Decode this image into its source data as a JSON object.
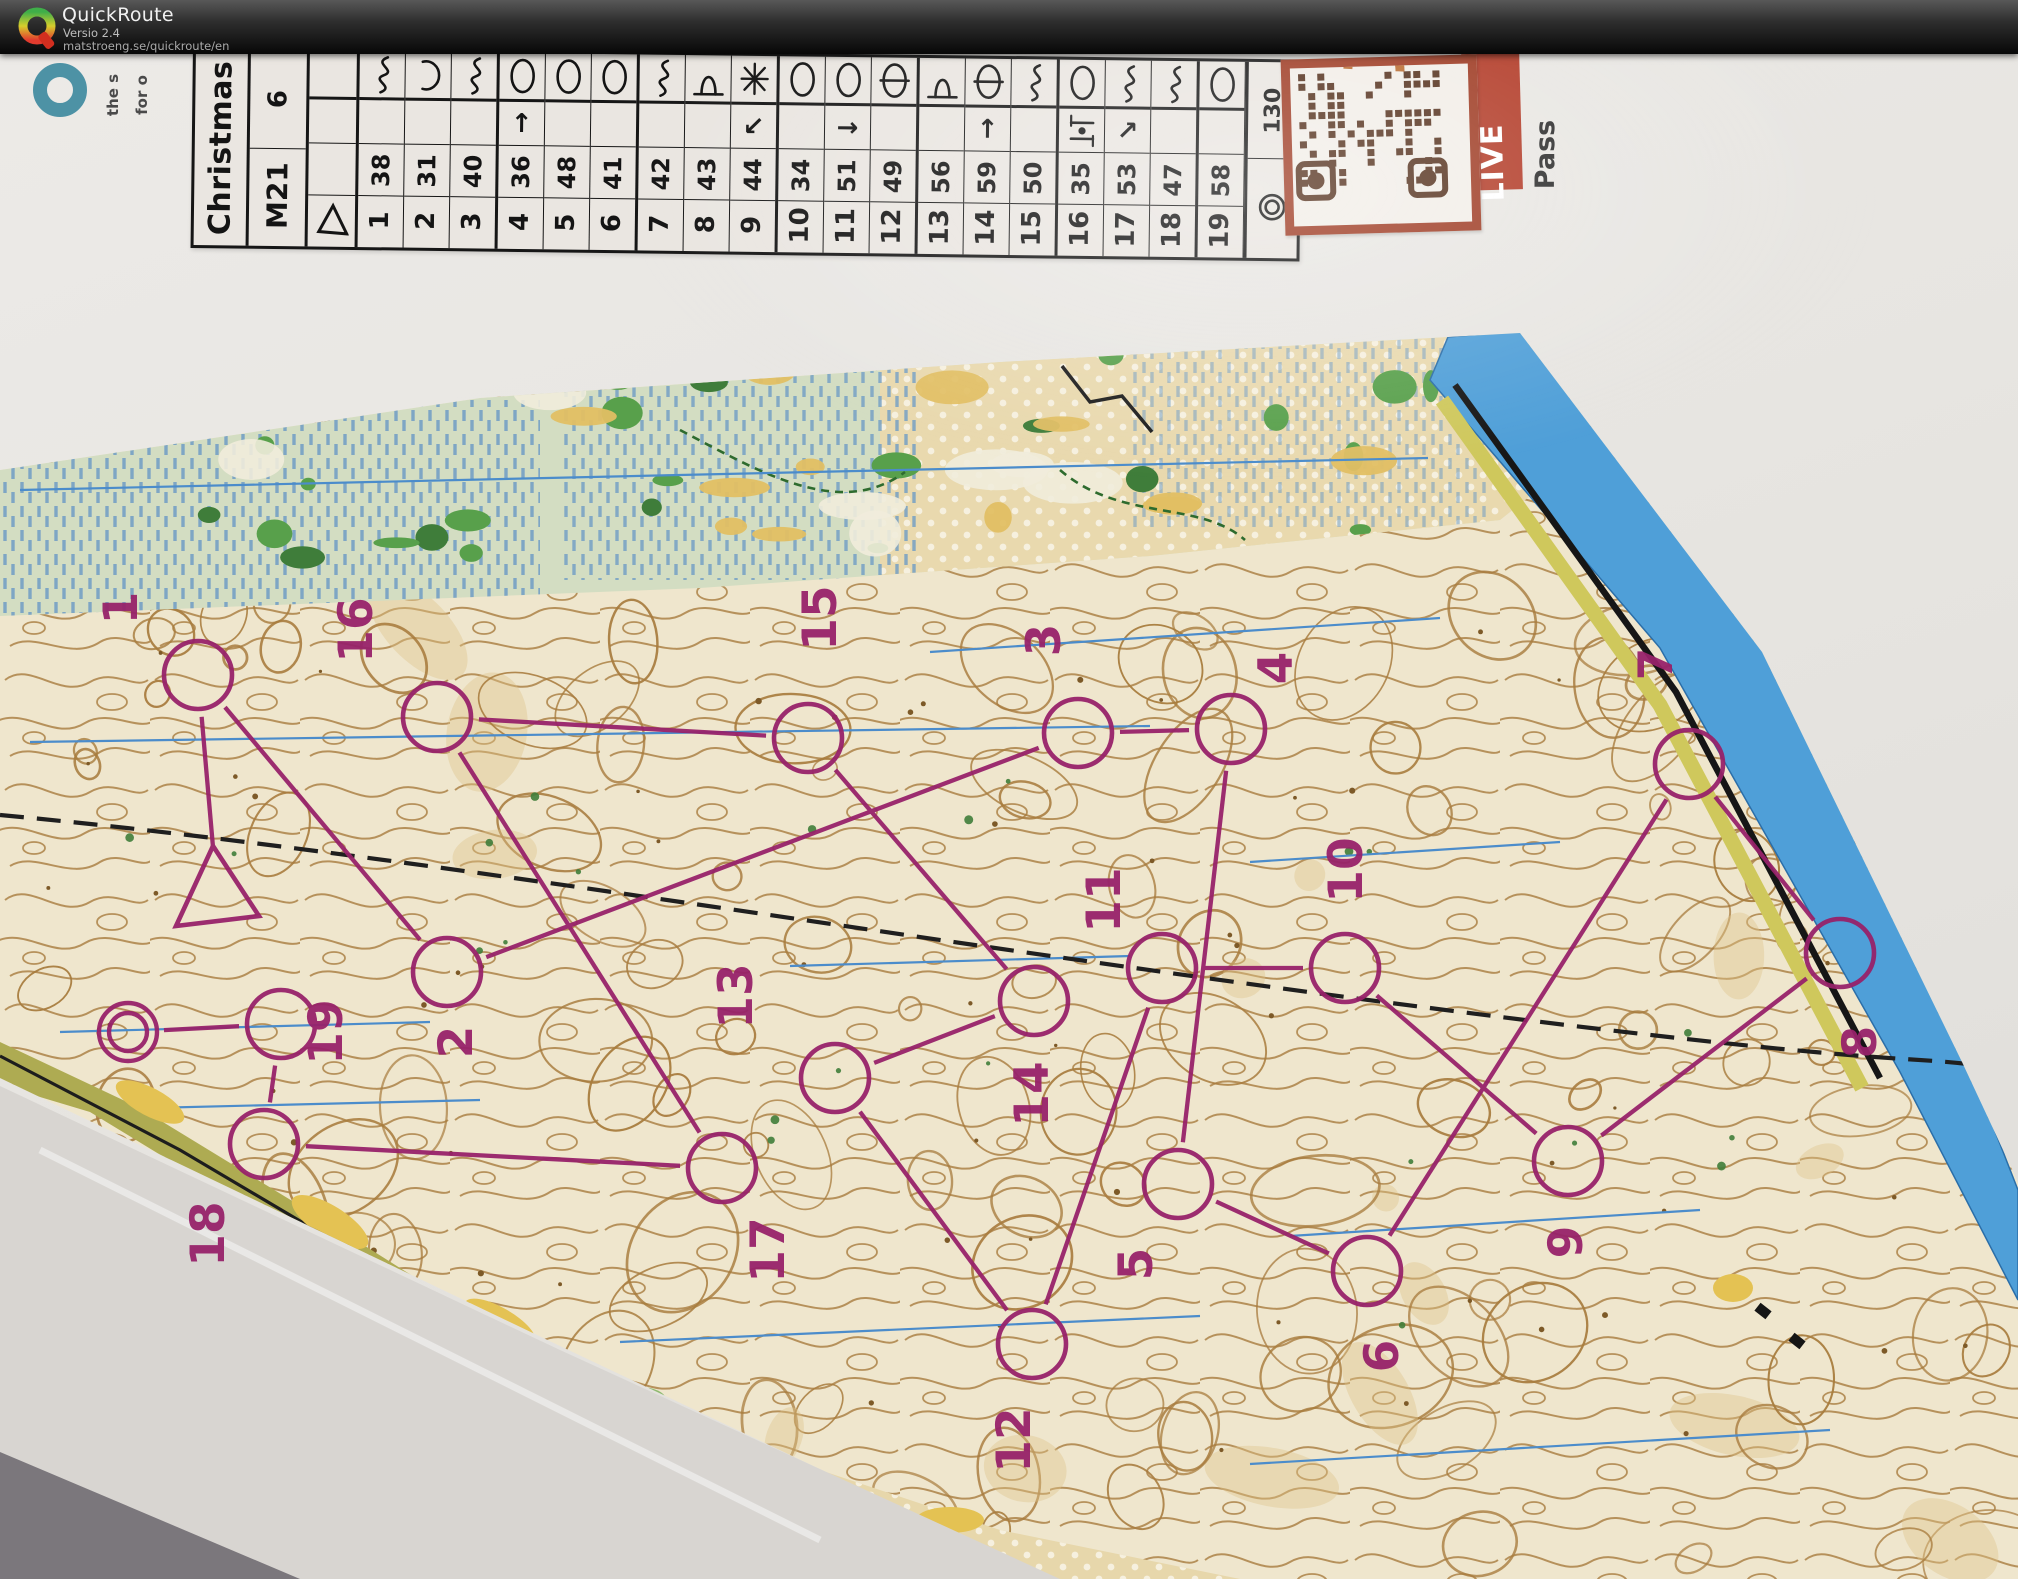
{
  "header": {
    "app_title": "QuickRoute",
    "version": "Versio 2.4",
    "website": "matstroeng.se/quickroute/en"
  },
  "photo": {
    "sponsor_logo": {
      "line1": "the s",
      "line2": "for o",
      "ring_color": "#4d92a5"
    },
    "sticker": {
      "live_label": "LIVE",
      "side_text": "Pass",
      "frame_color": "#9e3a22",
      "module_color": "#54301c"
    },
    "control_card": {
      "title": "Christmas",
      "course_class": "M21",
      "course_info": "6",
      "finish_distance": "130",
      "rows": [
        {
          "num": "1",
          "code": "38",
          "symbol": "curve",
          "arrow": ""
        },
        {
          "num": "2",
          "code": "31",
          "symbol": "c-open",
          "arrow": ""
        },
        {
          "num": "3",
          "code": "40",
          "symbol": "curve",
          "arrow": ""
        },
        {
          "num": "4",
          "code": "36",
          "symbol": "oval",
          "arrow": "↑"
        },
        {
          "num": "5",
          "code": "48",
          "symbol": "oval",
          "arrow": ""
        },
        {
          "num": "6",
          "code": "41",
          "symbol": "oval",
          "arrow": ""
        },
        {
          "num": "7",
          "code": "42",
          "symbol": "curve",
          "arrow": ""
        },
        {
          "num": "8",
          "code": "43",
          "symbol": "spur",
          "arrow": ""
        },
        {
          "num": "9",
          "code": "44",
          "symbol": "star",
          "arrow": "↙"
        },
        {
          "num": "10",
          "code": "34",
          "symbol": "oval",
          "arrow": ""
        },
        {
          "num": "11",
          "code": "51",
          "symbol": "oval",
          "arrow": "→"
        },
        {
          "num": "12",
          "code": "49",
          "symbol": "oval-bar",
          "arrow": ""
        },
        {
          "num": "13",
          "code": "56",
          "symbol": "spur",
          "arrow": ""
        },
        {
          "num": "14",
          "code": "59",
          "symbol": "oval-bar",
          "arrow": "↑"
        },
        {
          "num": "15",
          "code": "50",
          "symbol": "curve",
          "arrow": ""
        },
        {
          "num": "16",
          "code": "35",
          "symbol": "oval",
          "arrow": "between"
        },
        {
          "num": "17",
          "code": "53",
          "symbol": "curve",
          "arrow": "↗"
        },
        {
          "num": "18",
          "code": "47",
          "symbol": "curve",
          "arrow": ""
        },
        {
          "num": "19",
          "code": "58",
          "symbol": "oval",
          "arrow": ""
        }
      ]
    },
    "course": {
      "color": "#97226a",
      "start": {
        "x": 217,
        "y": 893
      },
      "finish": {
        "x": 128,
        "y": 1032
      },
      "controls": [
        {
          "num": "1",
          "cx": 198,
          "cy": 675,
          "lx": 137,
          "ly": 608
        },
        {
          "num": "2",
          "cx": 447,
          "cy": 972,
          "lx": 472,
          "ly": 1042
        },
        {
          "num": "3",
          "cx": 1078,
          "cy": 733,
          "lx": 1060,
          "ly": 640
        },
        {
          "num": "4",
          "cx": 1231,
          "cy": 729,
          "lx": 1292,
          "ly": 668
        },
        {
          "num": "5",
          "cx": 1178,
          "cy": 1184,
          "lx": 1152,
          "ly": 1264
        },
        {
          "num": "6",
          "cx": 1367,
          "cy": 1271,
          "lx": 1398,
          "ly": 1356
        },
        {
          "num": "7",
          "cx": 1689,
          "cy": 764,
          "lx": 1672,
          "ly": 664
        },
        {
          "num": "8",
          "cx": 1840,
          "cy": 953,
          "lx": 1876,
          "ly": 1042
        },
        {
          "num": "9",
          "cx": 1568,
          "cy": 1161,
          "lx": 1582,
          "ly": 1242
        },
        {
          "num": "10",
          "cx": 1345,
          "cy": 968,
          "lx": 1362,
          "ly": 870
        },
        {
          "num": "11",
          "cx": 1162,
          "cy": 968,
          "lx": 1120,
          "ly": 900
        },
        {
          "num": "12",
          "cx": 1032,
          "cy": 1344,
          "lx": 1030,
          "ly": 1440
        },
        {
          "num": "13",
          "cx": 835,
          "cy": 1078,
          "lx": 752,
          "ly": 996
        },
        {
          "num": "14",
          "cx": 1034,
          "cy": 1001,
          "lx": 1048,
          "ly": 1094
        },
        {
          "num": "15",
          "cx": 808,
          "cy": 738,
          "lx": 836,
          "ly": 618
        },
        {
          "num": "16",
          "cx": 437,
          "cy": 717,
          "lx": 372,
          "ly": 630
        },
        {
          "num": "17",
          "cx": 722,
          "cy": 1168,
          "lx": 784,
          "ly": 1250
        },
        {
          "num": "18",
          "cx": 264,
          "cy": 1144,
          "lx": 224,
          "ly": 1234
        },
        {
          "num": "19",
          "cx": 281,
          "cy": 1024,
          "lx": 342,
          "ly": 1032
        }
      ]
    }
  }
}
